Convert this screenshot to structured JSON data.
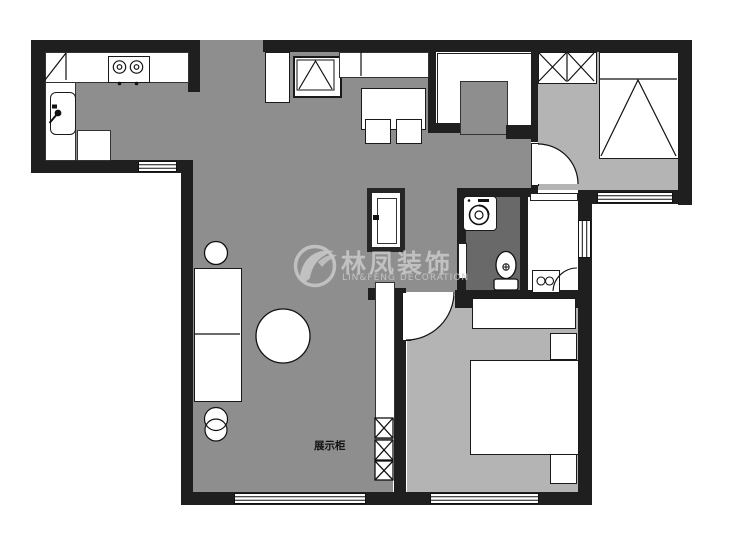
{
  "canvas": {
    "width": 740,
    "height": 533,
    "background": "#ffffff",
    "type": "apartment-floor-plan"
  },
  "watermark": {
    "brand_cn": "林凤装饰",
    "brand_en": "LIN&FENG DECORATION",
    "logo": "phoenix-swirl-icon",
    "color": "#c4c4c4"
  },
  "annotations": {
    "display_cabinet_label": "展示柜"
  },
  "palette": {
    "wall": "#1f1f1f",
    "floor_main": "#8e8e8e",
    "floor_bedroom": "#b4b4b4",
    "floor_bathroom": "#696969",
    "furniture_fill": "#ffffff",
    "outline": "#111111"
  },
  "symbols": [
    {
      "name": "corner-cabinet-icon",
      "room": "kitchen"
    },
    {
      "name": "stove-two-burner-icon",
      "room": "kitchen"
    },
    {
      "name": "sink-icon",
      "room": "kitchen"
    },
    {
      "name": "shoe-cabinet-icon",
      "room": "entry"
    },
    {
      "name": "cabinet-triangle-icon",
      "room": "entry"
    },
    {
      "name": "dining-table-icon",
      "room": "dining"
    },
    {
      "name": "stool-icon",
      "room": "dining"
    },
    {
      "name": "wardrobe-x-icon",
      "room": "bedroom-top-right"
    },
    {
      "name": "bed-icon",
      "room": "bedroom-top-right"
    },
    {
      "name": "door-arc-icon",
      "room": "bedroom-top-right"
    },
    {
      "name": "refrigerator-icon",
      "room": "hallway"
    },
    {
      "name": "washing-machine-icon",
      "room": "bathroom"
    },
    {
      "name": "toilet-icon",
      "room": "bathroom"
    },
    {
      "name": "vanity-basin-icon",
      "room": "washroom"
    },
    {
      "name": "display-cabinet-x-icon",
      "room": "living-room"
    },
    {
      "name": "sofa-icon",
      "room": "living-room"
    },
    {
      "name": "round-table-icon",
      "room": "living-room"
    },
    {
      "name": "side-table-icon",
      "room": "living-room"
    },
    {
      "name": "wardrobe-icon",
      "room": "bedroom-bottom-right"
    },
    {
      "name": "double-bed-icon",
      "room": "bedroom-bottom-right"
    },
    {
      "name": "nightstand-icon",
      "room": "bedroom-bottom-right"
    },
    {
      "name": "window-icon",
      "count": 5
    }
  ]
}
